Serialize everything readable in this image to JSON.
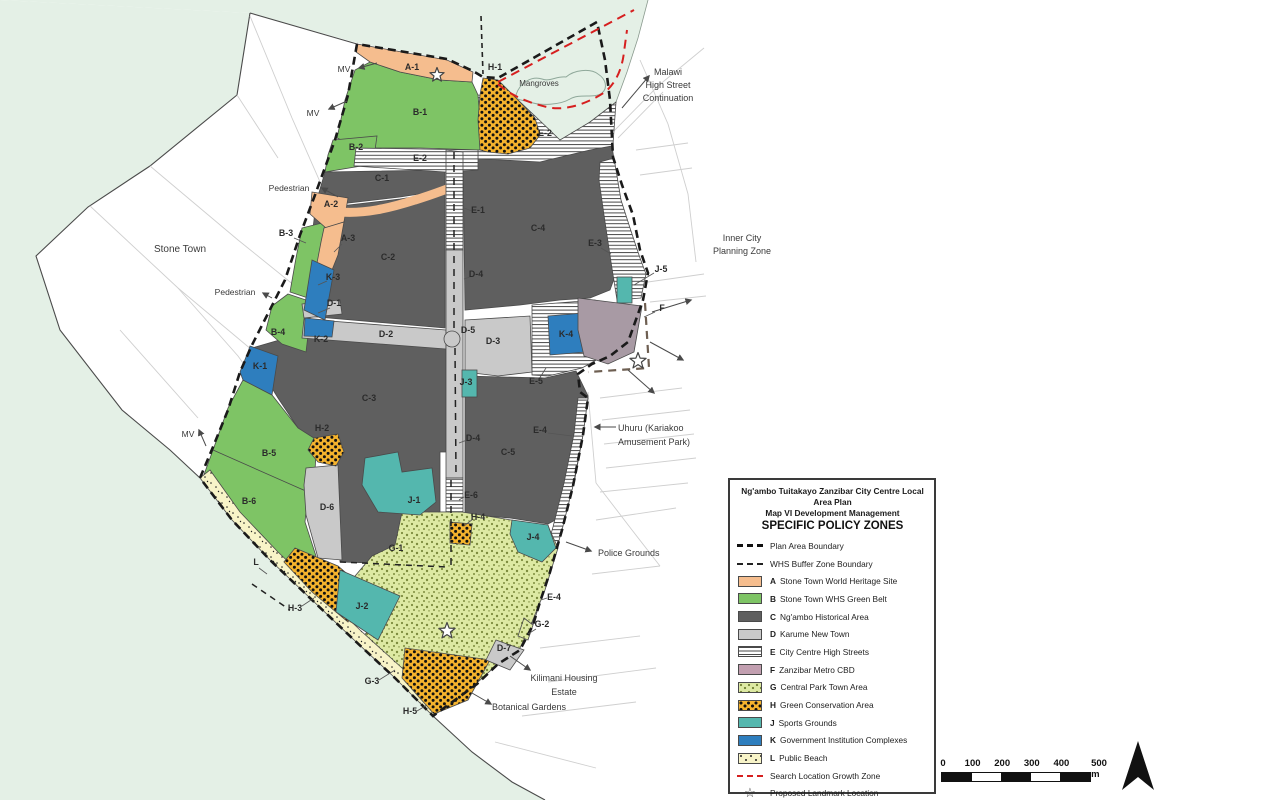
{
  "colors": {
    "sea": "#E4F0E6",
    "A": "#F5BD8E",
    "B": "#7EC465",
    "C": "#5F5F5F",
    "D": "#C9C9C9",
    "F": "#A89AA4",
    "Fleg": "#C29FB0",
    "Gbg": "#DDE9A3",
    "Gdot": "#7C8B3D",
    "H": "#F5B32D",
    "J": "#54B7AE",
    "K": "#2E7EBE",
    "Lbg": "#F8F4C8",
    "red": "#D61F1F",
    "boundary": "#1A1A1A"
  },
  "legend": {
    "title_lines": [
      "Ng'ambo Tuitakayo Zanzibar City Centre Local Area Plan",
      "Map VI Development Management",
      "SPECIFIC POLICY ZONES"
    ],
    "items": [
      {
        "type": "dash-bold",
        "letter": "",
        "label": "Plan Area Boundary"
      },
      {
        "type": "dash-thin",
        "letter": "",
        "label": "WHS Buffer Zone Boundary"
      },
      {
        "type": "swatch",
        "letter": "A",
        "label": "Stone Town World Heritage Site",
        "swatch": "A"
      },
      {
        "type": "swatch",
        "letter": "B",
        "label": "Stone Town WHS Green Belt",
        "swatch": "B"
      },
      {
        "type": "swatch",
        "letter": "C",
        "label": "Ng'ambo Historical Area",
        "swatch": "C"
      },
      {
        "type": "swatch",
        "letter": "D",
        "label": "Karume New Town",
        "swatch": "D"
      },
      {
        "type": "swatch",
        "letter": "E",
        "label": "City Centre High Streets",
        "swatch": "E"
      },
      {
        "type": "swatch",
        "letter": "F",
        "label": "Zanzibar Metro CBD",
        "swatch": "F"
      },
      {
        "type": "swatch",
        "letter": "G",
        "label": "Central Park Town Area",
        "swatch": "G"
      },
      {
        "type": "swatch",
        "letter": "H",
        "label": "Green Conservation Area",
        "swatch": "H"
      },
      {
        "type": "swatch",
        "letter": "J",
        "label": "Sports Grounds",
        "swatch": "J"
      },
      {
        "type": "swatch",
        "letter": "K",
        "label": "Government Institution Complexes",
        "swatch": "K"
      },
      {
        "type": "swatch",
        "letter": "L",
        "label": "Public Beach",
        "swatch": "L"
      },
      {
        "type": "dash-red",
        "letter": "",
        "label": "Search Location Growth Zone"
      },
      {
        "type": "star",
        "letter": "",
        "label": "Proposed Landmark Location"
      }
    ]
  },
  "scale_bar": {
    "ticks": [
      "0",
      "100",
      "200",
      "300",
      "400",
      "500 m"
    ],
    "segments": 5
  },
  "map": {
    "zone_labels": [
      {
        "t": "A-1",
        "x": 412,
        "y": 70
      },
      {
        "t": "H-1",
        "x": 495,
        "y": 70
      },
      {
        "t": "B-1",
        "x": 420,
        "y": 115
      },
      {
        "t": "E-2",
        "x": 545,
        "y": 136
      },
      {
        "t": "B-2",
        "x": 356,
        "y": 150
      },
      {
        "t": "E-2",
        "x": 420,
        "y": 161
      },
      {
        "t": "C-1",
        "x": 382,
        "y": 181
      },
      {
        "t": "A-2",
        "x": 331,
        "y": 207
      },
      {
        "t": "E-1",
        "x": 478,
        "y": 213
      },
      {
        "t": "C-4",
        "x": 538,
        "y": 231
      },
      {
        "t": "B-3",
        "x": 286,
        "y": 236
      },
      {
        "t": "A-3",
        "x": 348,
        "y": 241
      },
      {
        "t": "E-3",
        "x": 595,
        "y": 246
      },
      {
        "t": "C-2",
        "x": 388,
        "y": 260
      },
      {
        "t": "J-5",
        "x": 661,
        "y": 272
      },
      {
        "t": "D-4",
        "x": 476,
        "y": 277
      },
      {
        "t": "K-3",
        "x": 333,
        "y": 280
      },
      {
        "t": "D-1",
        "x": 334,
        "y": 306
      },
      {
        "t": "F",
        "x": 662,
        "y": 311
      },
      {
        "t": "D-5",
        "x": 468,
        "y": 333
      },
      {
        "t": "B-4",
        "x": 278,
        "y": 335
      },
      {
        "t": "D-2",
        "x": 386,
        "y": 337
      },
      {
        "t": "K-4",
        "x": 566,
        "y": 337
      },
      {
        "t": "K-2",
        "x": 321,
        "y": 342
      },
      {
        "t": "D-3",
        "x": 493,
        "y": 344
      },
      {
        "t": "K-1",
        "x": 260,
        "y": 369
      },
      {
        "t": "E-5",
        "x": 536,
        "y": 384
      },
      {
        "t": "J-3",
        "x": 466,
        "y": 385
      },
      {
        "t": "C-3",
        "x": 369,
        "y": 401
      },
      {
        "t": "H-2",
        "x": 322,
        "y": 431
      },
      {
        "t": "E-4",
        "x": 540,
        "y": 433
      },
      {
        "t": "D-4",
        "x": 473,
        "y": 441
      },
      {
        "t": "C-5",
        "x": 508,
        "y": 455
      },
      {
        "t": "B-5",
        "x": 269,
        "y": 456
      },
      {
        "t": "E-6",
        "x": 471,
        "y": 498
      },
      {
        "t": "J-1",
        "x": 414,
        "y": 503
      },
      {
        "t": "B-6",
        "x": 249,
        "y": 504
      },
      {
        "t": "D-6",
        "x": 327,
        "y": 510
      },
      {
        "t": "H-4",
        "x": 478,
        "y": 520
      },
      {
        "t": "J-4",
        "x": 533,
        "y": 540
      },
      {
        "t": "G-1",
        "x": 396,
        "y": 551
      },
      {
        "t": "L",
        "x": 256,
        "y": 565
      },
      {
        "t": "E-4",
        "x": 554,
        "y": 600
      },
      {
        "t": "J-2",
        "x": 362,
        "y": 609
      },
      {
        "t": "H-3",
        "x": 295,
        "y": 611
      },
      {
        "t": "G-2",
        "x": 542,
        "y": 627
      },
      {
        "t": "D-7",
        "x": 504,
        "y": 651
      },
      {
        "t": "G-3",
        "x": 372,
        "y": 684
      },
      {
        "t": "H-5",
        "x": 410,
        "y": 714
      }
    ],
    "annotations": [
      {
        "name": "stone-town",
        "lines": [
          "Stone Town"
        ],
        "x": 180,
        "y": 252,
        "size": 10,
        "anchor": "middle",
        "lh": 13
      },
      {
        "name": "mangroves",
        "lines": [
          "Mangroves"
        ],
        "x": 539,
        "y": 86,
        "size": 8,
        "anchor": "middle",
        "lh": 11
      },
      {
        "name": "malawi-high-street",
        "lines": [
          "Malawi",
          "High Street",
          "Continuation"
        ],
        "x": 668,
        "y": 75,
        "size": 9,
        "anchor": "middle",
        "lh": 13
      },
      {
        "name": "inner-city-planning-zone",
        "lines": [
          "Inner City",
          "Planning Zone"
        ],
        "x": 742,
        "y": 241,
        "size": 9,
        "anchor": "middle",
        "lh": 13
      },
      {
        "name": "uhuru-kariakoo",
        "lines": [
          "Uhuru (Kariakoo",
          "Amusement Park)"
        ],
        "x": 618,
        "y": 431,
        "size": 9,
        "anchor": "start",
        "lh": 14
      },
      {
        "name": "police-grounds",
        "lines": [
          "Police Grounds"
        ],
        "x": 598,
        "y": 556,
        "size": 9,
        "anchor": "start",
        "lh": 12
      },
      {
        "name": "kilimani-housing-estate",
        "lines": [
          "Kilimani Housing",
          "Estate"
        ],
        "x": 564,
        "y": 681,
        "size": 9,
        "anchor": "middle",
        "lh": 14
      },
      {
        "name": "botanical-gardens",
        "lines": [
          "Botanical Gardens"
        ],
        "x": 529,
        "y": 710,
        "size": 9,
        "anchor": "middle",
        "lh": 12
      },
      {
        "name": "mv-1",
        "lines": [
          "MV"
        ],
        "x": 344,
        "y": 72,
        "size": 8.5,
        "anchor": "middle",
        "lh": 10
      },
      {
        "name": "mv-2",
        "lines": [
          "MV"
        ],
        "x": 313,
        "y": 116,
        "size": 8.5,
        "anchor": "middle",
        "lh": 10
      },
      {
        "name": "mv-3",
        "lines": [
          "MV"
        ],
        "x": 188,
        "y": 437,
        "size": 8.5,
        "anchor": "middle",
        "lh": 10
      },
      {
        "name": "pedestrian-1",
        "lines": [
          "Pedestrian"
        ],
        "x": 289,
        "y": 191,
        "size": 8.5,
        "anchor": "middle",
        "lh": 10
      },
      {
        "name": "pedestrian-2",
        "lines": [
          "Pedestrian"
        ],
        "x": 235,
        "y": 295,
        "size": 8.5,
        "anchor": "middle",
        "lh": 10
      }
    ],
    "stars": [
      {
        "name": "landmark-star-1",
        "x": 437,
        "y": 75,
        "r": 7.5
      },
      {
        "name": "landmark-star-2",
        "x": 447,
        "y": 631,
        "r": 8.5
      },
      {
        "name": "landmark-star-3",
        "x": 638,
        "y": 361,
        "r": 8.5
      }
    ]
  }
}
